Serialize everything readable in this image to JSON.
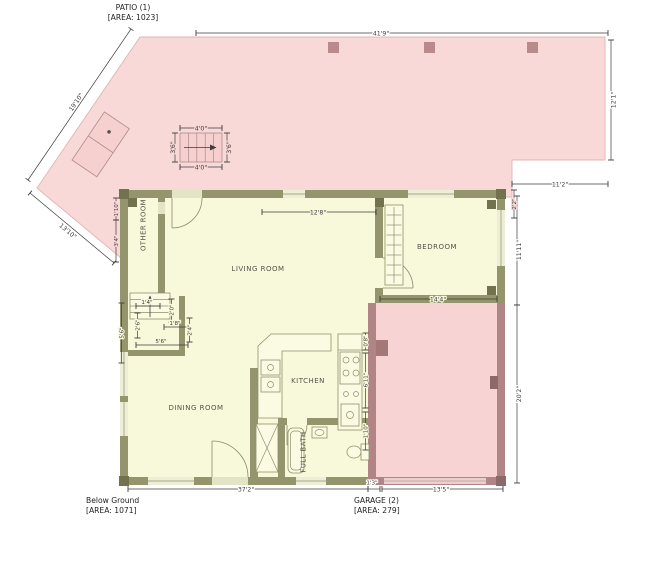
{
  "labels": {
    "patio_name": "PATIO (1)",
    "patio_area": "[AREA: 1023]",
    "floor_name": "Below Ground",
    "floor_area": "[AREA: 1071]",
    "garage_name": "GARAGE (2)",
    "garage_area": "[AREA: 279]"
  },
  "rooms": {
    "other_room": "OTHER ROOM",
    "living_room": "LIVING ROOM",
    "dining_room": "DINING ROOM",
    "kitchen": "KITCHEN",
    "full_bath": "FULL BATH",
    "bedroom": "BEDROOM"
  },
  "dims": {
    "patio_top_width": "41'9\"",
    "patio_right_height": "12'1\"",
    "patio_diagonal_upper": "19'10\"",
    "patio_diagonal_lower": "13'10\"",
    "patio_notch_width": "11'2\"",
    "patio_notch_height": "2'2\"",
    "patio_stairs_top": "4'0\"",
    "patio_stairs_bottom": "4'0\"",
    "patio_stairs_left": "3'6\"",
    "patio_stairs_right": "3'6\"",
    "living_room_top": "12'8\"",
    "bedroom_width": "14'4\"",
    "bedroom_height": "11'11\"",
    "garage_height": "20'2\"",
    "garage_width": "13'5\"",
    "floor_bottom_width": "37'2\"",
    "step_width": "1'3\"",
    "west_wall_upper": "1'10\"",
    "west_wall_lower": "3'4\"",
    "stair_dim_1": "1'4\"",
    "stair_dim_2": "2'0\"",
    "stair_dim_3": "2'6\"",
    "stair_dim_4": "1'8\"",
    "stair_dim_5": "2'4\"",
    "stair_dim_6": "5'6\"",
    "stair_dim_7": "5'6\"",
    "kitchen_wall_upper": "0'8\"",
    "kitchen_wall_mid": "6'11\"",
    "kitchen_wall_lower": "1'10\""
  },
  "colors": {
    "patio_fill": "#f9d8d8",
    "patio_column": "#b98a8a",
    "floor_fill": "#f8f8da",
    "wall": "#94946d",
    "wall_post": "#72724f",
    "garage_wall": "#b18585",
    "garage_fill": "#f8d3d3",
    "dimension": "#3d3d3d"
  }
}
